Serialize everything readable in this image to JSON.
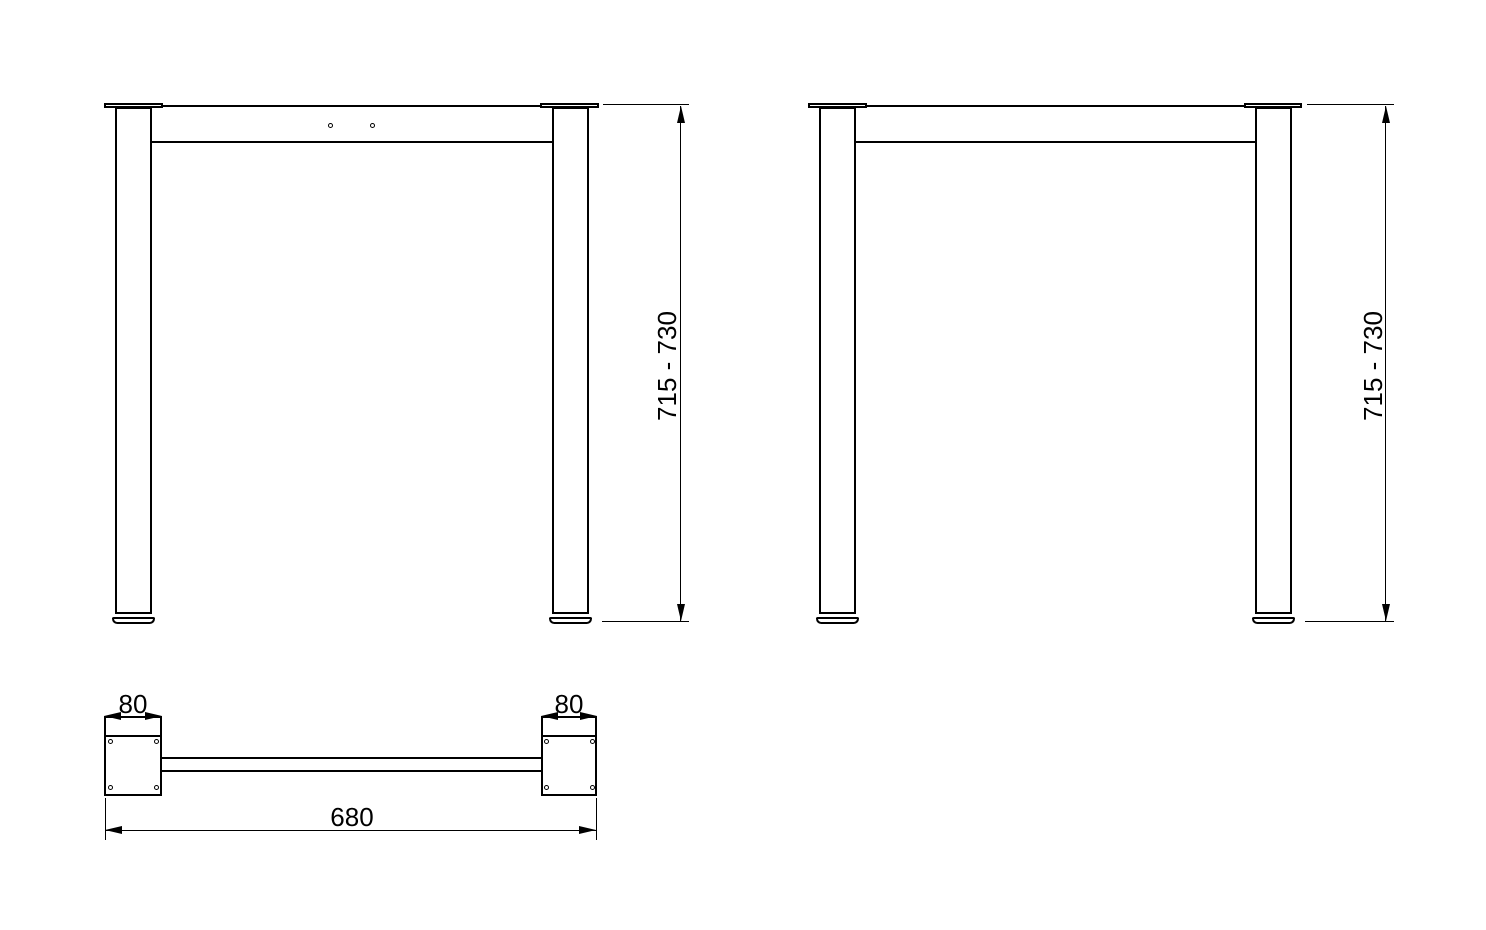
{
  "drawing": {
    "background_color": "#ffffff",
    "line_color": "#000000",
    "views": {
      "front": {
        "height_dimension_label": "715 - 730"
      },
      "side": {
        "height_dimension_label": "715 - 730"
      },
      "plan": {
        "left_plate_width_label": "80",
        "right_plate_width_label": "80",
        "overall_length_label": "680"
      }
    }
  }
}
